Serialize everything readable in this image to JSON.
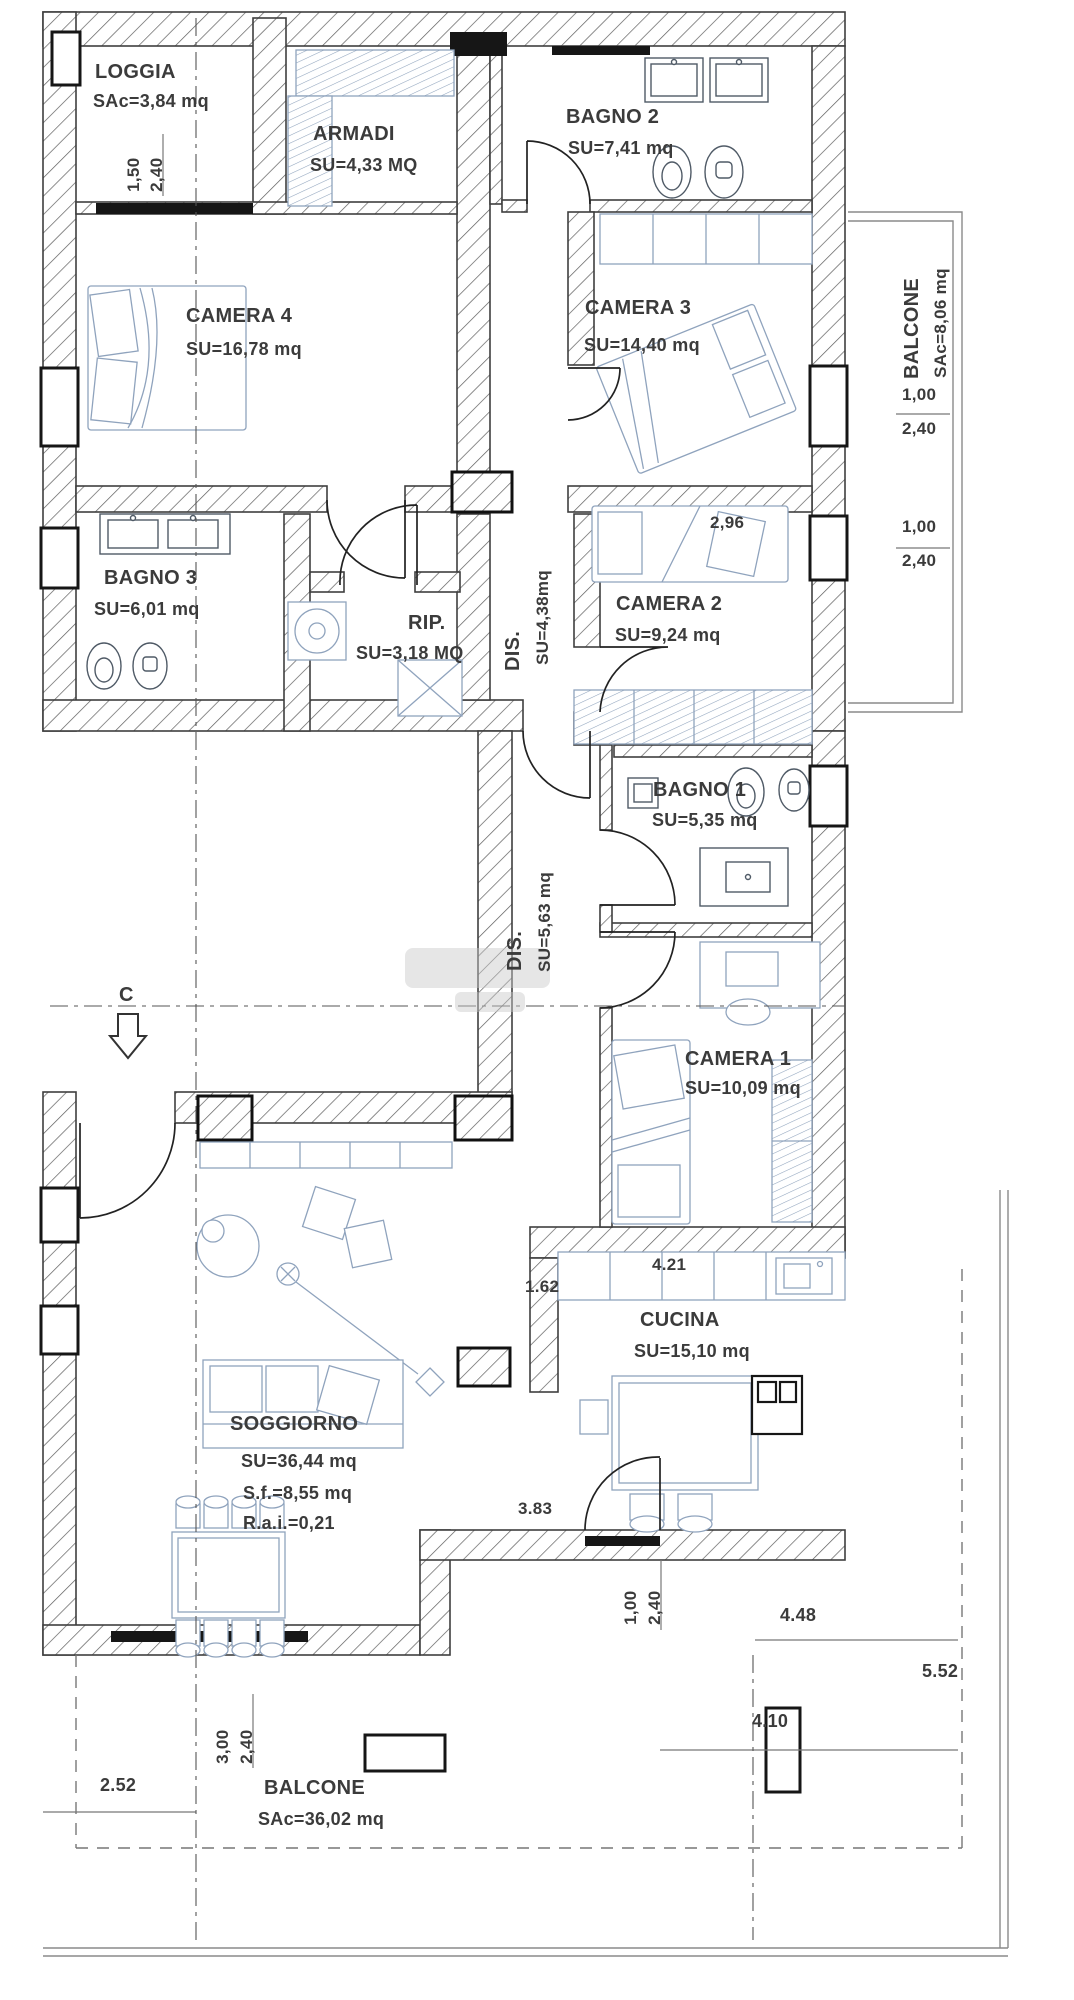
{
  "rooms": {
    "loggia": {
      "name": "LOGGIA",
      "area": "SAc=3,84 mq"
    },
    "armadi": {
      "name": "ARMADI",
      "area": "SU=4,33 MQ"
    },
    "bagno2": {
      "name": "BAGNO 2",
      "area": "SU=7,41 mq"
    },
    "camera4": {
      "name": "CAMERA 4",
      "area": "SU=16,78 mq"
    },
    "camera3": {
      "name": "CAMERA 3",
      "area": "SU=14,40 mq"
    },
    "balcone_right": {
      "name": "BALCONE",
      "area": "SAc=8,06 mq"
    },
    "bagno3": {
      "name": "BAGNO 3",
      "area": "SU=6,01 mq"
    },
    "rip": {
      "name": "RIP.",
      "area": "SU=3,18 MQ"
    },
    "dis1": {
      "name": "DIS.",
      "area": "SU=4,38mq"
    },
    "camera2": {
      "name": "CAMERA 2",
      "area": "SU=9,24 mq"
    },
    "bagno1": {
      "name": "BAGNO 1",
      "area": "SU=5,35 mq"
    },
    "dis2": {
      "name": "DIS.",
      "area": "SU=5,63 mq"
    },
    "camera1": {
      "name": "CAMERA 1",
      "area": "SU=10,09 mq"
    },
    "cucina": {
      "name": "CUCINA",
      "area": "SU=15,10 mq"
    },
    "soggiorno": {
      "name": "SOGGIORNO",
      "area": "SU=36,44 mq",
      "area_sf": "S.f.=8,55 mq",
      "area_rai": "R.a.i.=0,21"
    },
    "balcone_bottom": {
      "name": "BALCONE",
      "area": "SAc=36,02 mq"
    }
  },
  "dimensions": {
    "loggia_width": "1,50",
    "loggia_depth": "2,40",
    "balcone_right_upper_a": "1,00",
    "balcone_right_upper_b": "2,40",
    "balcone_right_lower_a": "1,00",
    "balcone_right_lower_b": "2,40",
    "camera2_width": "2,96",
    "cucina_top": "4.21",
    "cucina_left_upper": "1.62",
    "cucina_left_lower": "3.83",
    "cucina_door_a": "1,00",
    "cucina_door_b": "2,40",
    "balcone_bottom_left": "2.52",
    "balcone_bottom_door_a": "3,00",
    "balcone_bottom_door_b": "2,40",
    "balcone_bottom_right": "4.10",
    "terrace_width": "4.48",
    "terrace_side": "5.52"
  },
  "section_marker": "C"
}
